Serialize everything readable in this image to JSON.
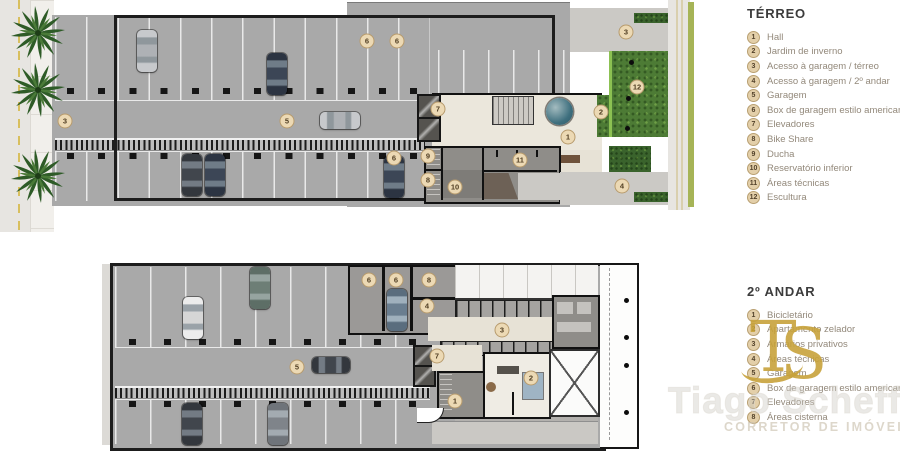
{
  "legend_terreo": {
    "title": "TÉRREO",
    "items": [
      {
        "num": "1",
        "label": "Hall"
      },
      {
        "num": "2",
        "label": "Jardim de inverno"
      },
      {
        "num": "3",
        "label": "Acesso à garagem / térreo"
      },
      {
        "num": "4",
        "label": "Acesso à garagem / 2º andar"
      },
      {
        "num": "5",
        "label": "Garagem"
      },
      {
        "num": "6",
        "label": "Box de garagem estilo americano"
      },
      {
        "num": "7",
        "label": "Elevadores"
      },
      {
        "num": "8",
        "label": "Bike Share"
      },
      {
        "num": "9",
        "label": "Ducha"
      },
      {
        "num": "10",
        "label": "Reservatório inferior"
      },
      {
        "num": "11",
        "label": "Áreas técnicas"
      },
      {
        "num": "12",
        "label": "Escultura"
      }
    ]
  },
  "legend_andar2": {
    "title": "2º ANDAR",
    "items": [
      {
        "num": "1",
        "label": "Bicicletário"
      },
      {
        "num": "2",
        "label": "Apartamento zelador"
      },
      {
        "num": "3",
        "label": "Armários privativos"
      },
      {
        "num": "4",
        "label": "Áreas técnicas"
      },
      {
        "num": "5",
        "label": "Garagem"
      },
      {
        "num": "6",
        "label": "Box de garagem estilo americano"
      },
      {
        "num": "7",
        "label": "Elevadores"
      },
      {
        "num": "8",
        "label": "Áreas cisterna"
      }
    ]
  },
  "watermark": {
    "initial_t": "T",
    "initial_s": "S",
    "name": "Tiago Scheffer",
    "tagline": "CORRETOR DE IMÓVEIS"
  },
  "markers": [
    {
      "n": "3",
      "x": 65,
      "y": 121
    },
    {
      "n": "5",
      "x": 287,
      "y": 121
    },
    {
      "n": "6",
      "x": 367,
      "y": 41
    },
    {
      "n": "6",
      "x": 397,
      "y": 41
    },
    {
      "n": "6",
      "x": 394,
      "y": 158
    },
    {
      "n": "7",
      "x": 438,
      "y": 109
    },
    {
      "n": "9",
      "x": 428,
      "y": 156
    },
    {
      "n": "8",
      "x": 428,
      "y": 180
    },
    {
      "n": "10",
      "x": 455,
      "y": 187
    },
    {
      "n": "11",
      "x": 520,
      "y": 160
    },
    {
      "n": "1",
      "x": 568,
      "y": 137
    },
    {
      "n": "2",
      "x": 601,
      "y": 112
    },
    {
      "n": "12",
      "x": 637,
      "y": 87
    },
    {
      "n": "3",
      "x": 626,
      "y": 32
    },
    {
      "n": "4",
      "x": 622,
      "y": 186
    },
    {
      "n": "6",
      "x": 369,
      "y": 280
    },
    {
      "n": "6",
      "x": 396,
      "y": 280
    },
    {
      "n": "8",
      "x": 429,
      "y": 280
    },
    {
      "n": "4",
      "x": 427,
      "y": 306
    },
    {
      "n": "3",
      "x": 502,
      "y": 330
    },
    {
      "n": "7",
      "x": 437,
      "y": 356
    },
    {
      "n": "5",
      "x": 297,
      "y": 367
    },
    {
      "n": "1",
      "x": 455,
      "y": 401
    },
    {
      "n": "2",
      "x": 531,
      "y": 378
    }
  ],
  "colors": {
    "garage_gray": "#a9a9a9",
    "hall_beige": "#ebe7dc",
    "garden_green": "#4d7b35",
    "marker_tan": "#ecd9b4",
    "watermark_gold": "#c8a33b"
  }
}
